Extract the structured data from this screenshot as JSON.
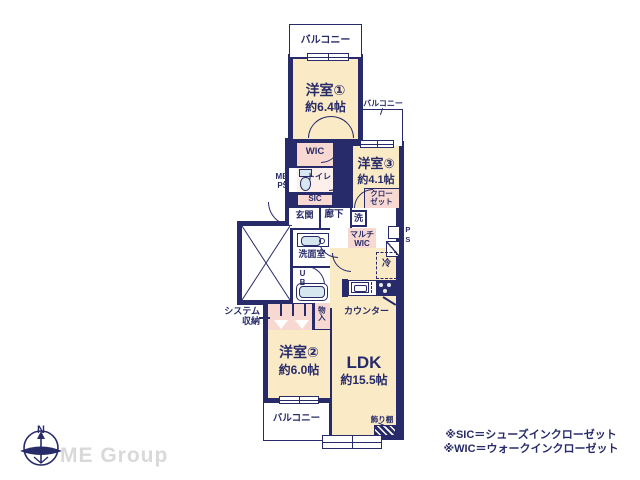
{
  "colors": {
    "wall_navy": "#282b69",
    "room_cream": "#faeac5",
    "closet_pink": "#f7d9d2",
    "fixture_blue": "#d7e7f0",
    "logo_gray": "#d9d9d9"
  },
  "plan": {
    "balcony_top": "バルコニー",
    "balcony_right": "バルコニー",
    "balcony_bottom": "バルコニー",
    "room1": {
      "name": "洋室①",
      "size": "約6.4帖"
    },
    "room2": {
      "name": "洋室②",
      "size": "約6.0帖"
    },
    "room3": {
      "name": "洋室③",
      "size": "約4.1帖"
    },
    "ldk": {
      "name": "LDK",
      "size": "約15.5帖"
    },
    "wic": "WIC",
    "toilet": "トイレ",
    "mb": "MB",
    "ps_left": "PS",
    "sic": "SIC",
    "genkan": "玄関",
    "hallway": "廊下",
    "closet_l1": "クロー",
    "closet_l2": "ゼット",
    "washer": "洗",
    "multi_wic_l1": "マルチ",
    "multi_wic_l2": "WIC",
    "fridge": "冷",
    "ps_right": "PS",
    "washroom": "洗面室",
    "unit_bath": "UB",
    "system_l1": "システム",
    "system_l2": "収納",
    "storage_small": "物入",
    "counter": "カウンター",
    "display_shelf": "飾り棚"
  },
  "footer": {
    "compass_north": "N",
    "company": "ME Group"
  },
  "legend": {
    "sic": "※SIC＝シューズインクローゼット",
    "wic": "※WIC＝ウォークインクローゼット"
  }
}
